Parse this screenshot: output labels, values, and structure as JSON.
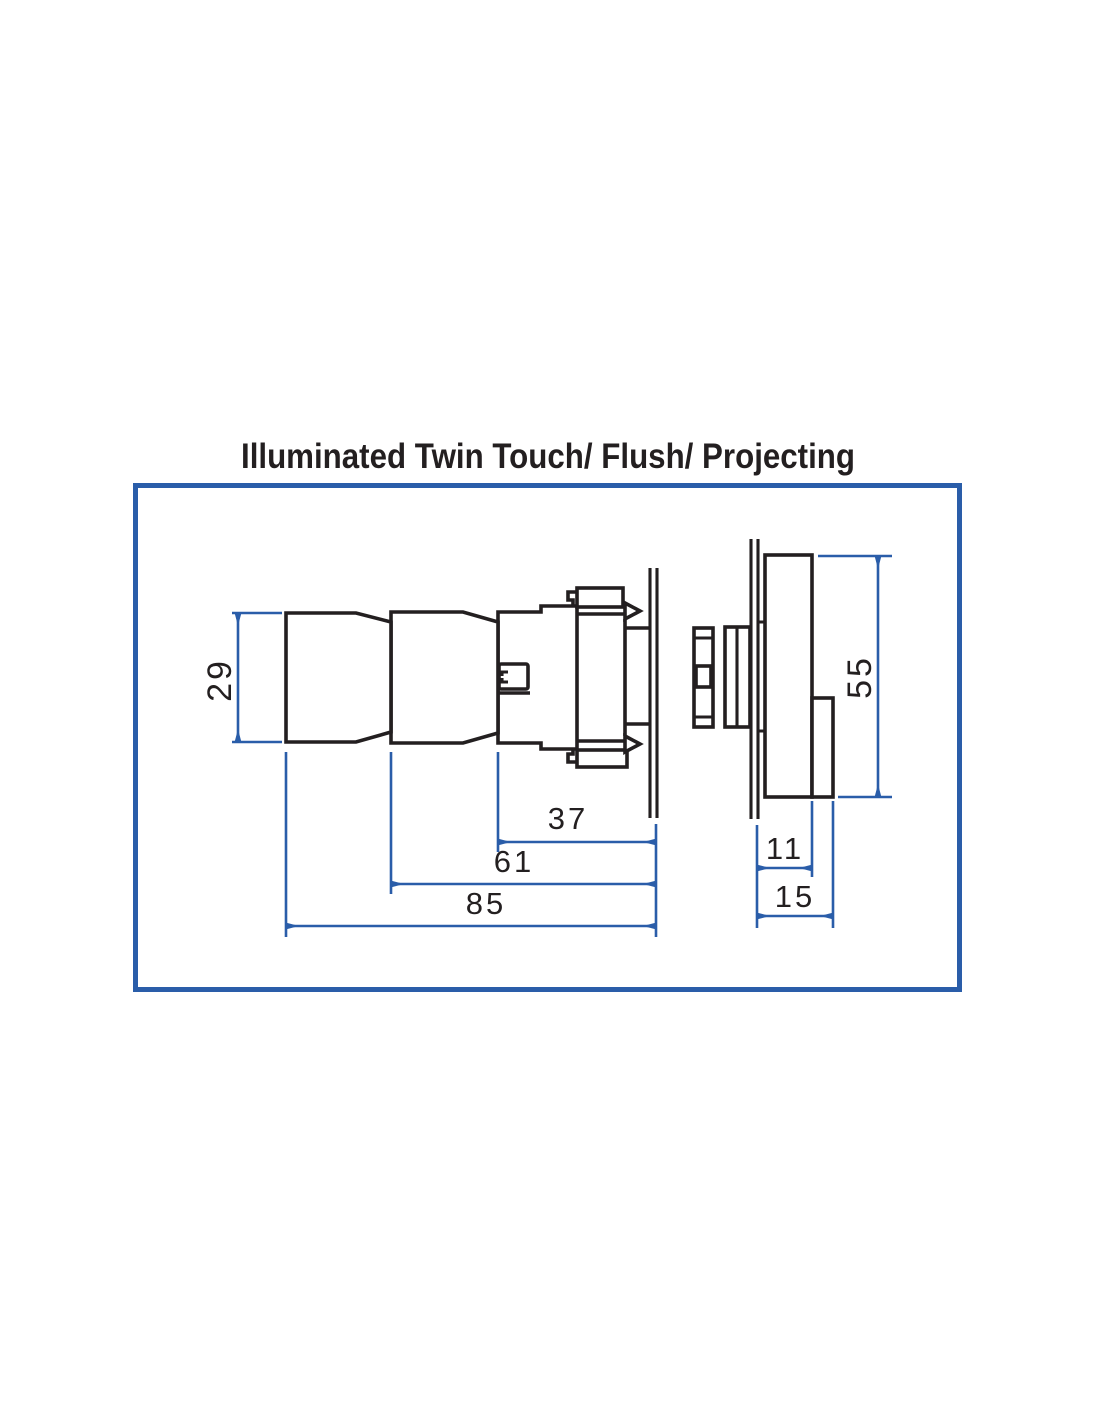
{
  "title": "Illuminated Twin Touch/ Flush/ Projecting",
  "colors": {
    "frame_blue": "#2a5da9",
    "dimension_blue": "#2a5da9",
    "outline_black": "#231f20",
    "background": "#ffffff"
  },
  "drawing": {
    "dimensions": {
      "operator_height": "29",
      "depth_bezel_to_panel": "37",
      "depth_body_to_panel": "61",
      "depth_overall": "85",
      "rear_unit_height": "55",
      "rear_unit_depth": "11",
      "rear_unit_depth_overall": "15"
    }
  }
}
